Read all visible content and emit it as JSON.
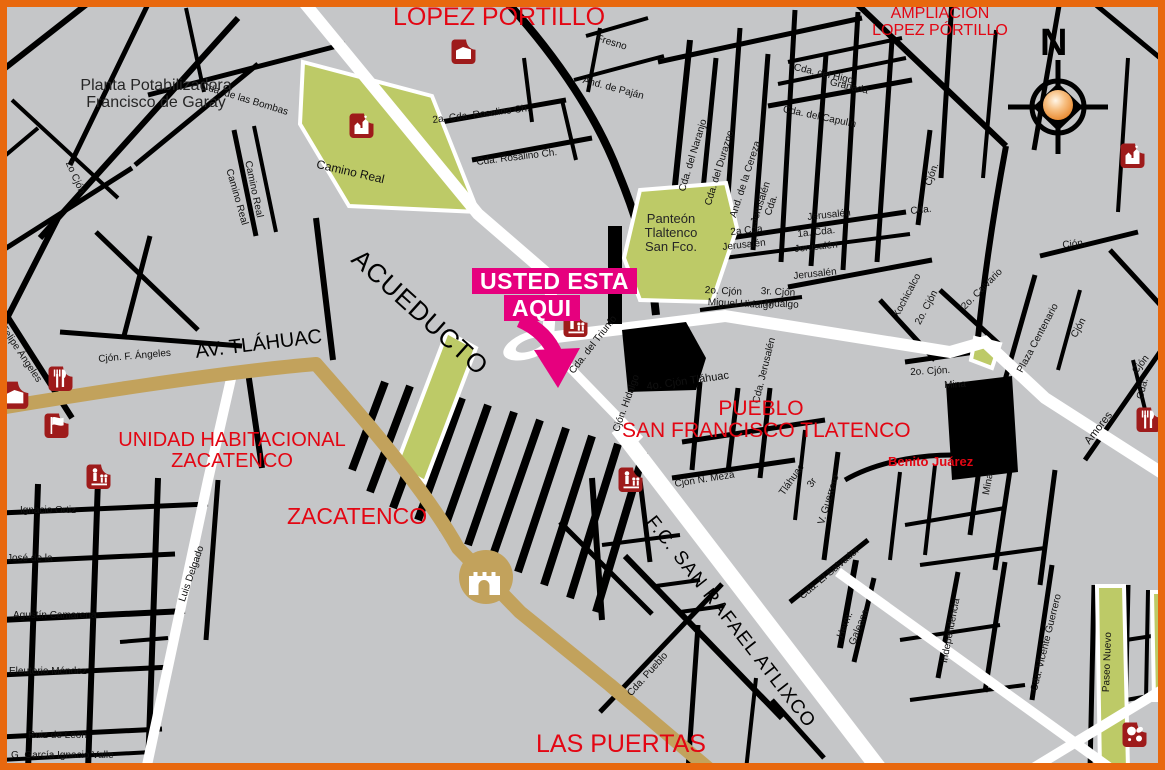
{
  "areas": [
    "LOPEZ PÓRTILLO",
    "AMPLIACIÓN",
    "LOPEZ PÓRTILLO",
    "UNIDAD HABITACIONAL",
    "ZACATENCO",
    "ZACATENCO",
    "PUEBLO",
    "SAN FRANCISCO TLATENCO",
    "Benito Juárez",
    "LAS PUERTAS"
  ],
  "you_are_here": {
    "line1": "USTED ESTA",
    "line2": "AQUI"
  },
  "major_roads": [
    "ACUEDUCTO",
    "AV. TLÁHUAC",
    "F.C. SAN RAFAEL ATLIXCO"
  ],
  "poi": {
    "planta1": "Planta Potabilizadora",
    "planta2": "Francisco de Garay",
    "panteon1": "Panteón",
    "panteon2": "Tlaltenco",
    "panteon3": "San Fco."
  },
  "compass": {
    "north": "N"
  },
  "streets": [
    "Cda. de las Bombas",
    "Camino Real",
    "Camino Real",
    "Camino Real",
    "2o Cjón",
    "2a. Cda. Rosalino Ch.",
    "Cda. Rosalino Ch.",
    "Fresno",
    "And. de Paján",
    "Cda. del Higo",
    "Granada",
    "Cda. del Capulín",
    "Cda. del Naranjo",
    "Cda. del Durazno",
    "And. de la Cereza",
    "Jerusalén",
    "Cda.",
    "2a Cda.",
    "Jerusalén",
    "1a. Cda.",
    "Jerusalén",
    "Jerusalén",
    "Jerusalén",
    "2o. Cjón",
    "Miguel Hidalgo",
    "3r. Cjón",
    "Hidalgo",
    "Cjón.",
    "Cjón.",
    "Cda.",
    "2o. Calvario",
    "Xochicalco",
    "2o. Cjón",
    "Plaza Centenario",
    "Cjón",
    "2o. Cjón.",
    "Mina",
    "Mina",
    "Amores",
    "Cjón",
    "Cda.",
    "Cda. del Triunfo",
    "Cjón. Hidalgo",
    "4o. Cjón Tláhuac",
    "Cda. Jerusalén",
    "Cjón N. Meza",
    "Tláhuac",
    "3r",
    "V. Guerrero",
    "Cda. El Salvador",
    "Herm.",
    "Galeana",
    "Independencia",
    "Cda. Pueblo",
    "Cda. Vicente Guerrero",
    "Paseo Nuevo",
    "Felipe Ángeles",
    "Cjón. F. Ángeles",
    "Agustín Camarena",
    "Luis Delgado",
    "Ignacio Ortiz",
    "José de la",
    "Eleuterio Méndez",
    "Ruiz de León",
    "G. García Ignacio Valle"
  ],
  "icons": [
    {
      "name": "church-icon"
    },
    {
      "name": "building-icon"
    },
    {
      "name": "church-icon"
    },
    {
      "name": "restaurant-icon"
    },
    {
      "name": "building-icon"
    },
    {
      "name": "flag-icon"
    },
    {
      "name": "market-icon"
    },
    {
      "name": "market-icon"
    },
    {
      "name": "market-icon"
    },
    {
      "name": "restaurant-icon"
    },
    {
      "name": "sports-icon"
    },
    {
      "name": "gate-icon"
    }
  ],
  "colors": {
    "background": "#c5c6c8",
    "road_black": "#000000",
    "road_white": "#ffffff",
    "road_tan": "#c2a25c",
    "green_area": "#bdca67",
    "label_red": "#e30613",
    "marker_magenta": "#e6007e",
    "icon_red": "#9e1b1b",
    "border_orange": "#e8680e"
  }
}
